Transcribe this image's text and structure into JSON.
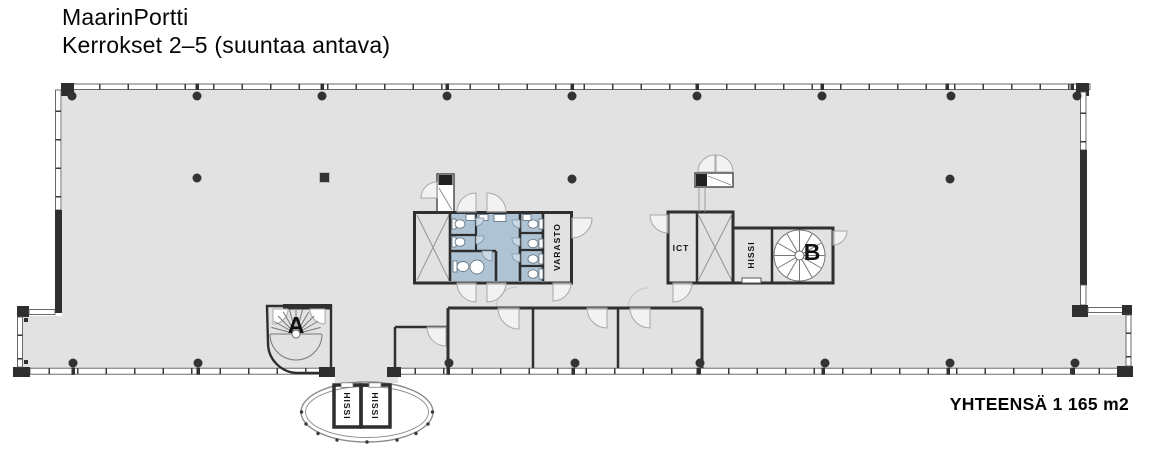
{
  "title": {
    "line1": "MaarinPortti",
    "line2": "Kerrokset 2–5 (suuntaa antava)"
  },
  "summary": {
    "total_area": "YHTEENSÄ 1 165 m2"
  },
  "labels": {
    "stair_a": "A",
    "stair_b": "B",
    "ict": "ICT",
    "varasto": "VARASTO",
    "hissi_core": "HISSI",
    "hissi_bay_left": "HISSI",
    "hissi_bay_right": "HISSI"
  },
  "colors": {
    "floor": "#e2e2e2",
    "wall": "#2f2f2f",
    "wet_area_blue": "#aec3d4",
    "background": "#ffffff"
  }
}
